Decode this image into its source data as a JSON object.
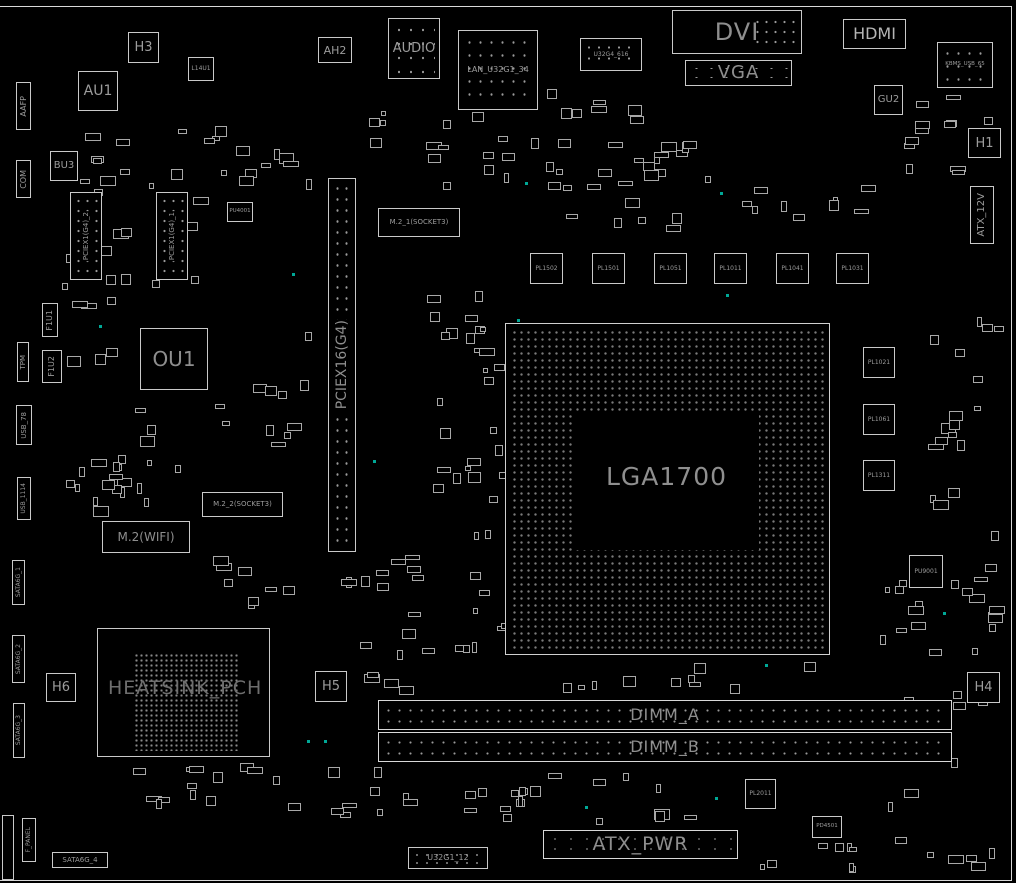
{
  "diagram": {
    "rear_panel": {
      "audio": "AUDIO",
      "lan_usb": "LAN_U32G1_34",
      "usb_header_top": "U32G4_616",
      "dvi": "DVI",
      "vga": "VGA",
      "hdmi": "HDMI",
      "kbms_usb": "KBMS_USB_65"
    },
    "chips": {
      "h3": "H3",
      "au1": "AU1",
      "l14u1": "L14U1",
      "bu3": "BU3",
      "ah2": "AH2",
      "gu2": "GU2",
      "h1": "H1",
      "ou1": "OU1",
      "pu4001": "PU4001",
      "f1u1": "F1U1",
      "f1u2": "F1U2",
      "pu9001": "PU9001",
      "h4": "H4",
      "h5": "H5",
      "h6": "H6"
    },
    "left_headers": {
      "aafp": "AAFP",
      "com": "COM",
      "tpm": "TPM",
      "usb_78": "USB_78",
      "usb_1114": "USB_1114",
      "sata6g_1": "SATA6G_1",
      "sata6g_2": "SATA6G_2",
      "sata6g_3": "SATA6G_3",
      "sata6g_4": "SATA6G_4",
      "f_panel": "F_PANEL"
    },
    "slots": {
      "pciex16": "PCIEX16(G4)",
      "pciex1_1": "PCIEX1(G4)_1",
      "pciex1_2": "PCIEX1(G4)_2",
      "m2_1": "M.2_1(SOCKET3)",
      "m2_2": "M.2_2(SOCKET3)",
      "m2_wifi": "M.2(WIFI)",
      "dimm_a": "DIMM_A",
      "dimm_b": "DIMM_B"
    },
    "power": {
      "atx_pwr": "ATX_PWR",
      "atx_12v": "ATX_12V"
    },
    "cpu_socket_label": "LGA1700",
    "pch_label": "HEATSINK_PCH",
    "inductors_top_row": [
      "PL1502",
      "PL1501",
      "PL1051",
      "PL1011",
      "PL1041",
      "PL1031"
    ],
    "inductors_right": [
      "PL1021",
      "PL1061",
      "PL1311"
    ],
    "bottom": {
      "pl2011": "PL2011",
      "pd4501": "PD4501",
      "u32g1_12": "U32G1_12"
    },
    "colors": {
      "background": "#000000",
      "outline": "#c9c9c9",
      "label": "#9c9c9c",
      "testpoint": "#00a896"
    }
  }
}
